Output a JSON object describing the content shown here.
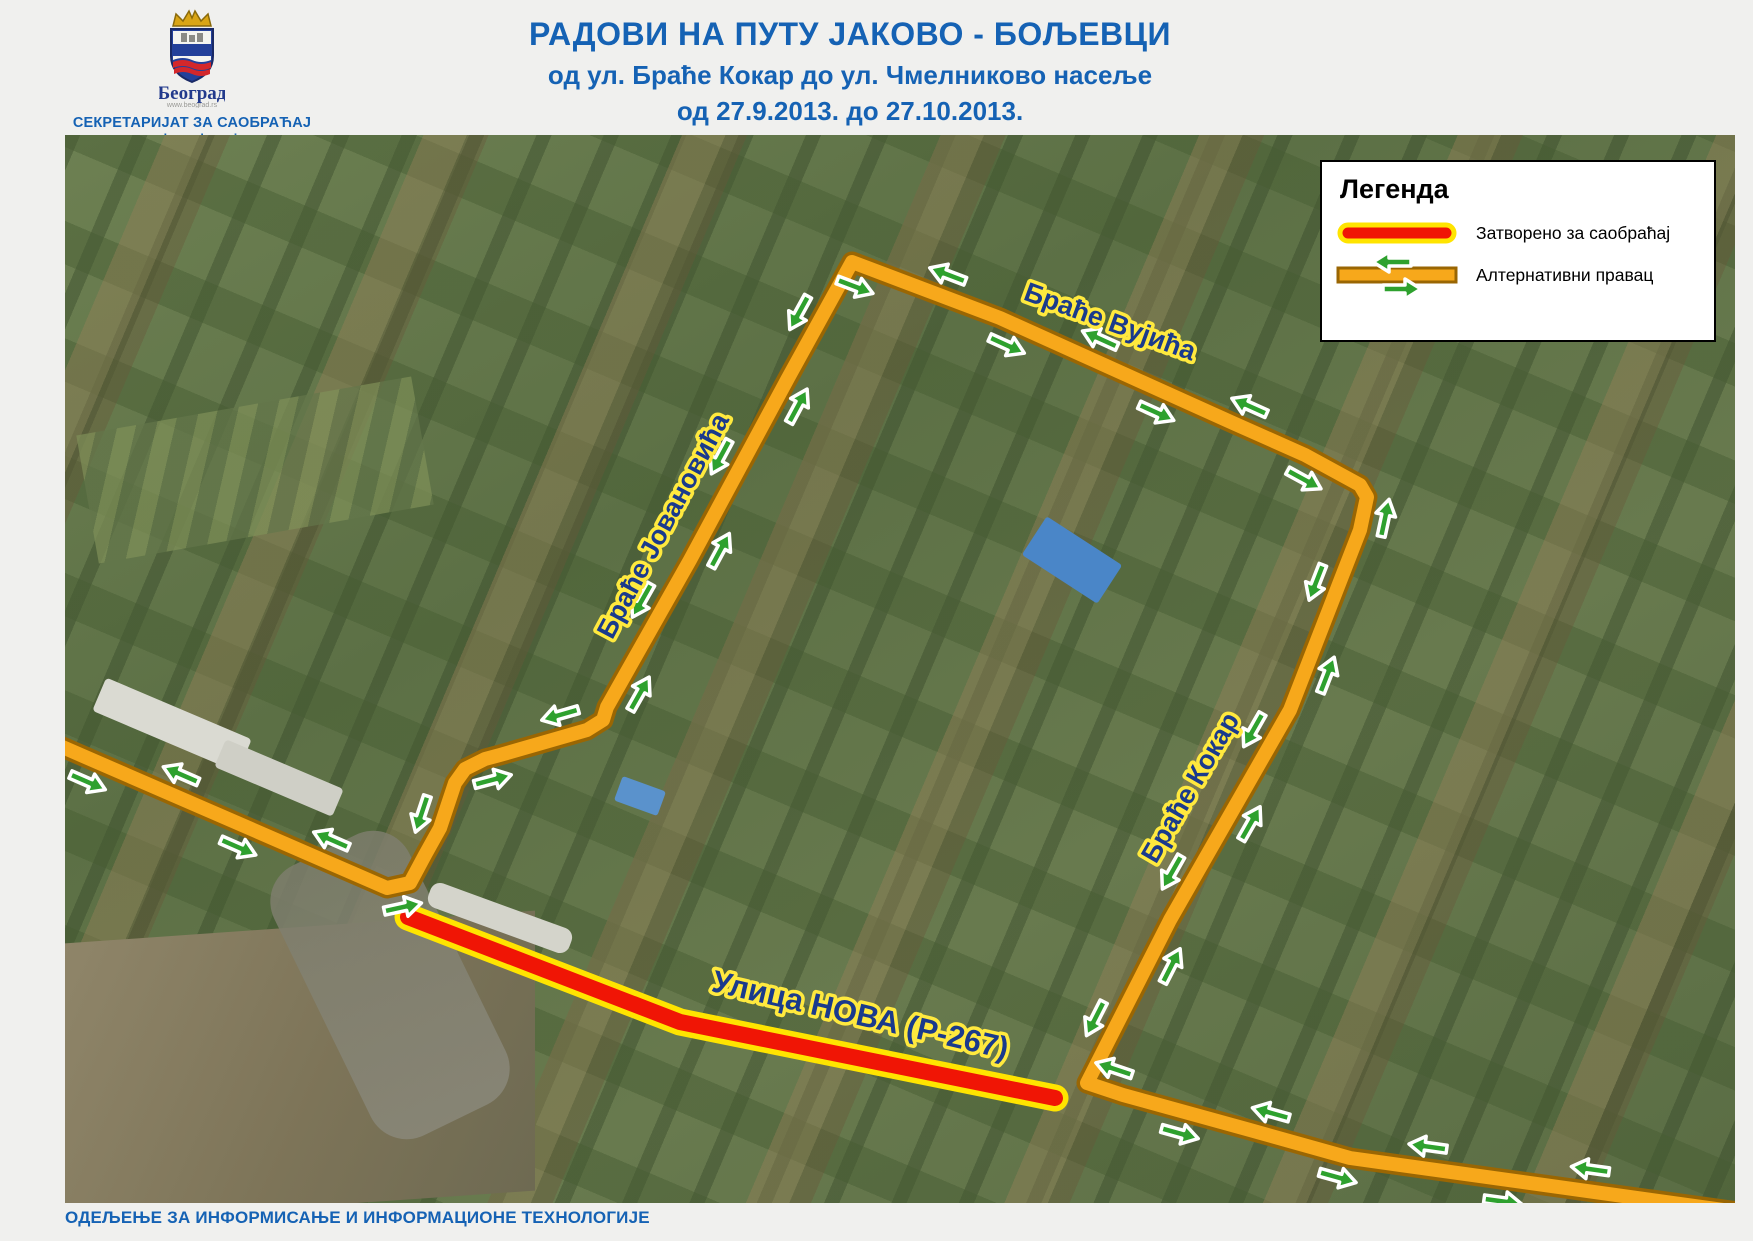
{
  "colors": {
    "accent_blue": "#1562b4",
    "road_orange": "#F7A81B",
    "road_border": "#9A6603",
    "closed_red": "#F01505",
    "closed_yellow": "#FFE400",
    "arrow_green": "#2EA12E",
    "label_navy": "#1A3A8C",
    "label_halo": "#FFE93E"
  },
  "header": {
    "logo": {
      "city_name": "Београд",
      "city_url": "www.beograd.rs"
    },
    "secretariat": "СЕКРЕТАРИЈАТ ЗА САОБРАЋАЈ",
    "secretariat_url": "www.bgsaobracaj.rs",
    "title_line1": "РАДОВИ НА ПУТУ ЈАКОВО - БОЉЕВЦИ",
    "title_line2": "од ул. Браће Кокар до ул. Чмелниково насеље",
    "title_line3": "од 27.9.2013. до 27.10.2013."
  },
  "legend": {
    "title": "Легенда",
    "items": [
      {
        "icon": "closed-road-icon",
        "label": "Затворено за саобраћај"
      },
      {
        "icon": "alternative-route-icon",
        "label": "Алтернативни правац"
      }
    ]
  },
  "map": {
    "street_labels": [
      {
        "text": "Браће Вујића",
        "x": 1042,
        "y": 195,
        "rotation": 20,
        "size": 27
      },
      {
        "text": "Браће Јовановића",
        "x": 606,
        "y": 395,
        "rotation": -62,
        "size": 27
      },
      {
        "text": "Браће Кокар",
        "x": 1133,
        "y": 657,
        "rotation": -60,
        "size": 27
      },
      {
        "text": "Улица НОВА (Р-267)",
        "x": 793,
        "y": 890,
        "rotation": 13,
        "size": 31
      }
    ],
    "routes": {
      "alternative": {
        "name": "Алтернативни правац",
        "points": [
          [
            -5,
            611
          ],
          [
            322,
            753
          ],
          [
            345,
            748
          ],
          [
            360,
            720
          ],
          [
            375,
            693
          ],
          [
            390,
            648
          ],
          [
            400,
            634
          ],
          [
            420,
            624
          ],
          [
            435,
            620
          ],
          [
            522,
            595
          ],
          [
            538,
            585
          ],
          [
            542,
            572
          ],
          [
            625,
            425
          ],
          [
            722,
            245
          ],
          [
            787,
            127
          ],
          [
            935,
            183
          ],
          [
            1168,
            288
          ],
          [
            1240,
            320
          ],
          [
            1295,
            350
          ],
          [
            1302,
            362
          ],
          [
            1295,
            395
          ],
          [
            1225,
            575
          ],
          [
            1105,
            785
          ],
          [
            1022,
            948
          ],
          [
            1058,
            960
          ],
          [
            1185,
            995
          ],
          [
            1285,
            1023
          ],
          [
            1680,
            1078
          ]
        ],
        "arrow_spacing": 82
      },
      "closed": {
        "name": "Затворено за саобраћај",
        "points": [
          [
            343,
            782
          ],
          [
            615,
            887
          ],
          [
            990,
            963
          ]
        ]
      }
    }
  },
  "footer": {
    "department": "ОДЕЉЕЊЕ ЗА ИНФОРМИСАЊЕ И ИНФОРМАЦИОНЕ ТЕХНОЛОГИЈЕ"
  }
}
